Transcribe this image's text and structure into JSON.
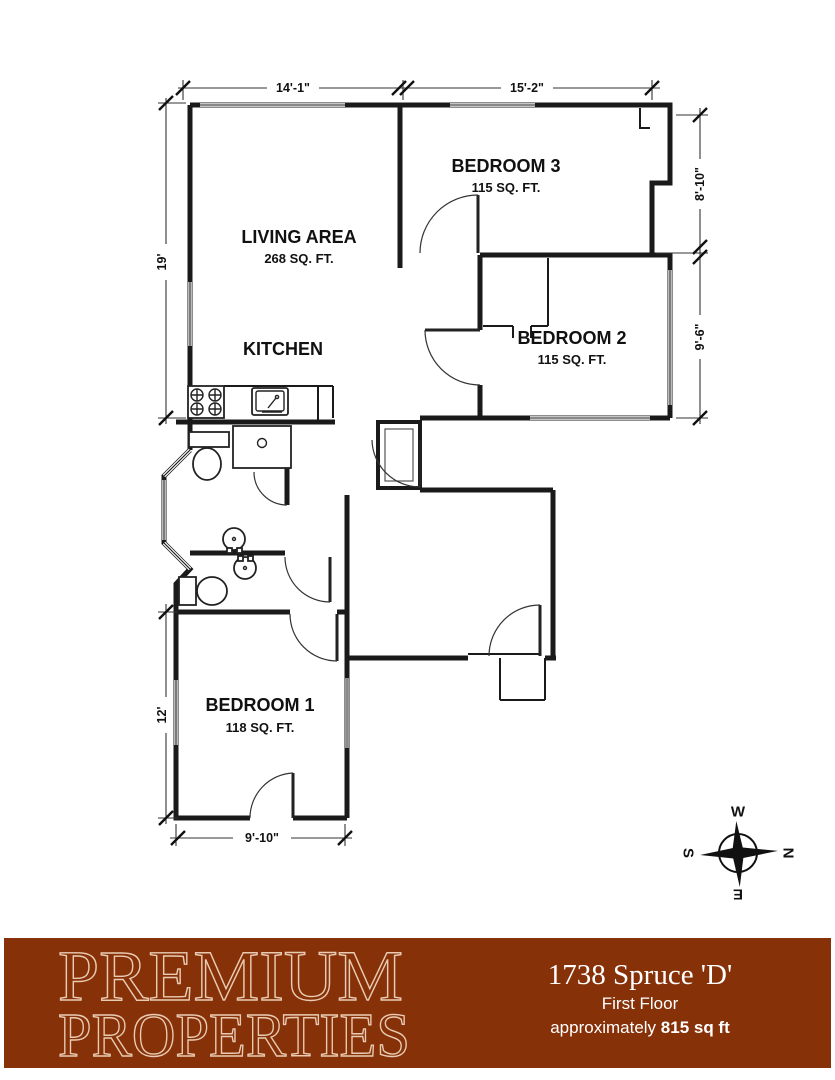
{
  "plan": {
    "rooms": [
      {
        "name": "LIVING AREA",
        "area": "268 SQ. FT."
      },
      {
        "name": "KITCHEN",
        "area": ""
      },
      {
        "name": "BEDROOM 3",
        "area": "115 SQ. FT."
      },
      {
        "name": "BEDROOM 2",
        "area": "115 SQ. FT."
      },
      {
        "name": "BEDROOM 1",
        "area": "118 SQ. FT."
      }
    ],
    "dimensions": {
      "top_left": "14'-1\"",
      "top_right": "15'-2\"",
      "left_upper": "19'",
      "right_upper": "8'-10\"",
      "right_lower": "9'-6\"",
      "left_lower": "12'",
      "bottom": "9'-10\""
    },
    "compass": {
      "north": "N",
      "south": "S",
      "east": "E",
      "west": "W"
    }
  },
  "footer": {
    "brand_line1": "PREMIUM",
    "brand_line2": "PROPERTIES",
    "address": "1738 Spruce 'D'",
    "floor": "First Floor",
    "approx_prefix": "approximately ",
    "area_value": "815 sq ft"
  },
  "colors": {
    "footer_background": "#873108",
    "brand_outline": "#e8cbb2",
    "wall": "#1a1a1a",
    "window_gray": "#8a8a8a",
    "footer_text": "#ffffff"
  }
}
